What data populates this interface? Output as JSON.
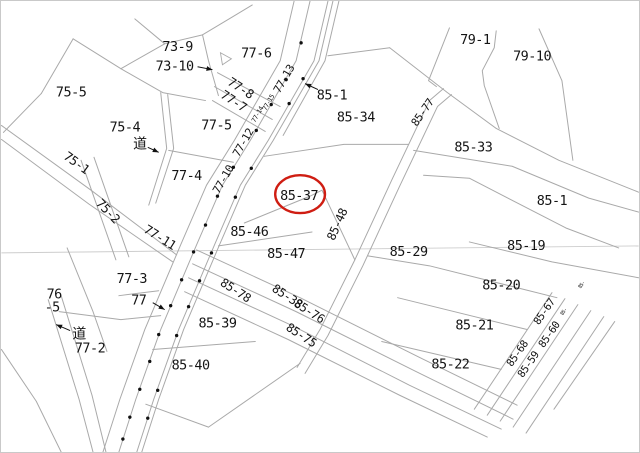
{
  "map": {
    "title": "cadastral-parcel-map",
    "highlight": {
      "parcel": "85-37",
      "color": "#cf1d12"
    },
    "colors": {
      "line": "#a9a9a9",
      "faint": "#cdcdcd",
      "text": "#141414",
      "dot": "#111111"
    },
    "labels": [
      {
        "t": "73-9",
        "x": 177,
        "y": 50,
        "r": 0,
        "s": 13.5
      },
      {
        "t": "73-10",
        "x": 174,
        "y": 70,
        "r": 0,
        "s": 13.5
      },
      {
        "t": "77-6",
        "x": 256,
        "y": 57,
        "r": 0,
        "s": 13.5
      },
      {
        "t": "75-5",
        "x": 70,
        "y": 96,
        "r": 0,
        "s": 13.5
      },
      {
        "t": "77-8",
        "x": 238,
        "y": 91,
        "r": 33,
        "s": 12.5
      },
      {
        "t": "77-7",
        "x": 231,
        "y": 104,
        "r": 33,
        "s": 12.5
      },
      {
        "t": "77-5",
        "x": 216,
        "y": 129,
        "r": 0,
        "s": 13.5
      },
      {
        "t": "75-4",
        "x": 124,
        "y": 131,
        "r": 0,
        "s": 13.5
      },
      {
        "t": "道",
        "x": 139,
        "y": 148,
        "r": 0,
        "s": 14
      },
      {
        "t": "77-13",
        "x": 287,
        "y": 80,
        "r": -60,
        "s": 11
      },
      {
        "t": "77-15",
        "x": 270,
        "y": 103,
        "r": -60,
        "s": 6.5
      },
      {
        "t": "77-14",
        "x": 259,
        "y": 115,
        "r": -60,
        "s": 6.5
      },
      {
        "t": "77-12",
        "x": 246,
        "y": 144,
        "r": -60,
        "s": 11
      },
      {
        "t": "77-10",
        "x": 226,
        "y": 181,
        "r": -60,
        "s": 11
      },
      {
        "t": "85-1",
        "x": 332,
        "y": 99,
        "r": 0,
        "s": 13.5
      },
      {
        "t": "85-34",
        "x": 356,
        "y": 121,
        "r": 0,
        "s": 13.5
      },
      {
        "t": "85-77",
        "x": 426,
        "y": 114,
        "r": -55,
        "s": 11
      },
      {
        "t": "79-1",
        "x": 476,
        "y": 43,
        "r": 0,
        "s": 13.5
      },
      {
        "t": "79-10",
        "x": 533,
        "y": 60,
        "r": 0,
        "s": 13.5
      },
      {
        "t": "85-33",
        "x": 474,
        "y": 151,
        "r": 0,
        "s": 13.5
      },
      {
        "t": "85-1",
        "x": 553,
        "y": 205,
        "r": 0,
        "s": 13.5
      },
      {
        "t": "75-1",
        "x": 73,
        "y": 166,
        "r": 36,
        "s": 12.5
      },
      {
        "t": "77-4",
        "x": 186,
        "y": 180,
        "r": 0,
        "s": 13.5
      },
      {
        "t": "75-2",
        "x": 104,
        "y": 214,
        "r": 46,
        "s": 12.5
      },
      {
        "t": "85-37",
        "x": 299,
        "y": 200,
        "r": 0,
        "s": 13.5
      },
      {
        "t": "85-48",
        "x": 341,
        "y": 226,
        "r": -66,
        "s": 12
      },
      {
        "t": "77-11",
        "x": 157,
        "y": 241,
        "r": 32,
        "s": 12.5
      },
      {
        "t": "85-46",
        "x": 249,
        "y": 236,
        "r": 0,
        "s": 13.5
      },
      {
        "t": "85-47",
        "x": 286,
        "y": 258,
        "r": 0,
        "s": 13.5
      },
      {
        "t": "85-29",
        "x": 409,
        "y": 256,
        "r": 0,
        "s": 13.5
      },
      {
        "t": "85-19",
        "x": 527,
        "y": 250,
        "r": 0,
        "s": 13.5
      },
      {
        "t": "77-3",
        "x": 131,
        "y": 283,
        "r": 0,
        "s": 13.5
      },
      {
        "t": "77",
        "x": 138,
        "y": 305,
        "r": 0,
        "s": 13.5
      },
      {
        "t": "76",
        "x": 53,
        "y": 299,
        "r": 0,
        "s": 13.5
      },
      {
        "t": "-5",
        "x": 51,
        "y": 312,
        "r": 0,
        "s": 13.5
      },
      {
        "t": "85-78",
        "x": 233,
        "y": 294,
        "r": 33,
        "s": 12
      },
      {
        "t": "85-38",
        "x": 285,
        "y": 300,
        "r": 33,
        "s": 12
      },
      {
        "t": "85-76",
        "x": 307,
        "y": 315,
        "r": 33,
        "s": 12
      },
      {
        "t": "85-75",
        "x": 299,
        "y": 339,
        "r": 33,
        "s": 12
      },
      {
        "t": "道",
        "x": 78,
        "y": 339,
        "r": 0,
        "s": 14
      },
      {
        "t": "77-2",
        "x": 89,
        "y": 353,
        "r": 0,
        "s": 13.5
      },
      {
        "t": "85-39",
        "x": 217,
        "y": 328,
        "r": 0,
        "s": 13.5
      },
      {
        "t": "85-40",
        "x": 190,
        "y": 370,
        "r": 0,
        "s": 13.5
      },
      {
        "t": "85-20",
        "x": 502,
        "y": 290,
        "r": 0,
        "s": 13.5
      },
      {
        "t": "85-21",
        "x": 475,
        "y": 330,
        "r": 0,
        "s": 13.5
      },
      {
        "t": "85-22",
        "x": 451,
        "y": 369,
        "r": 0,
        "s": 13.5
      },
      {
        "t": "85-67",
        "x": 548,
        "y": 314,
        "r": -55,
        "s": 10.5
      },
      {
        "t": "85-60",
        "x": 553,
        "y": 337,
        "r": -55,
        "s": 10.5
      },
      {
        "t": "85-68",
        "x": 521,
        "y": 356,
        "r": -55,
        "s": 10.5
      },
      {
        "t": "85-59",
        "x": 532,
        "y": 367,
        "r": -55,
        "s": 10.5
      },
      {
        "t": "85-",
        "x": 566,
        "y": 313,
        "r": -55,
        "s": 5
      },
      {
        "t": "85-",
        "x": 584,
        "y": 286,
        "r": -55,
        "s": 5
      }
    ],
    "polylines": [
      {
        "p": "294,0 280,60 234,140 206,185 180,245 144,330 119,400 102,453"
      },
      {
        "p": "310,0 296,60 250,140 222,185 196,245 160,330 135,400 118,453"
      },
      {
        "p": "328,0 314,60 268,140 240,185 214,245 178,330 153,400 136,453"
      },
      {
        "p": "333,0 319,60 273,140 245,185 219,245 183,330 158,400 141,453"
      },
      {
        "p": "339,0 325,60 283,135"
      },
      {
        "p": "134,18 164,43"
      },
      {
        "p": "164,43 202,34"
      },
      {
        "p": "202,34 232,16 252,4"
      },
      {
        "p": "202,34 208,60 218,95"
      },
      {
        "p": "164,43 120,68"
      },
      {
        "p": "72,38 120,68 162,92 205,100"
      },
      {
        "p": "72,38 40,93"
      },
      {
        "p": "40,93 2,132"
      },
      {
        "p": "160,92 166,148 148,205"
      },
      {
        "p": "167,94 173,148 155,203"
      },
      {
        "p": "217,72 280,106"
      },
      {
        "p": "214,86 272,119"
      },
      {
        "p": "212,100 265,131"
      },
      {
        "p": "168,150 233,162"
      },
      {
        "p": "0,125 90,190 176,255"
      },
      {
        "p": "0,139 88,204 172,262"
      },
      {
        "p": "80,160 115,260"
      },
      {
        "p": "93,157 128,257"
      },
      {
        "p": "66,248 92,312 106,352"
      },
      {
        "p": "47,300 78,400 92,453"
      },
      {
        "p": "60,296 91,396 105,453"
      },
      {
        "p": "0,350 35,402 60,453"
      },
      {
        "p": "58,312 120,320 160,316"
      },
      {
        "p": "118,296 158,291"
      },
      {
        "p": "390,47 448,92 497,128 560,160 640,192"
      },
      {
        "p": "414,150 513,166 590,198 640,212"
      },
      {
        "p": "424,175 470,178 567,228 620,248"
      },
      {
        "p": "450,27 429,80 437,86"
      },
      {
        "p": "497,30 495,47 483,70 485,85 500,128"
      },
      {
        "p": "540,28 563,80 574,160"
      },
      {
        "p": "328,55 390,47"
      },
      {
        "p": "444,88 430,100 392,180 355,260 320,330 297,368"
      },
      {
        "p": "452,94 438,106 400,186 363,266 328,336 305,374"
      },
      {
        "p": "322,190 355,260"
      },
      {
        "p": "264,156 344,144 409,144"
      },
      {
        "p": "244,223 310,196 322,190"
      },
      {
        "p": "218,246 312,232"
      },
      {
        "p": "196,250 300,298 420,358 518,406"
      },
      {
        "p": "192,264 296,312 416,372 514,420"
      },
      {
        "p": "188,278 292,326 410,386 502,430"
      },
      {
        "p": "184,292 288,340 400,396 488,438"
      },
      {
        "p": "470,242 553,262 640,278"
      },
      {
        "p": "368,256 430,266 558,298"
      },
      {
        "p": "398,298 528,330"
      },
      {
        "p": "382,342 502,370"
      },
      {
        "p": "553,293 475,410"
      },
      {
        "p": "566,299 488,416"
      },
      {
        "p": "579,305 501,422"
      },
      {
        "p": "592,311 514,428"
      },
      {
        "p": "605,317 527,434"
      },
      {
        "p": "616,322 555,410"
      },
      {
        "p": "145,405 208,428"
      },
      {
        "p": "208,428 300,364"
      },
      {
        "p": "152,350 255,342"
      }
    ],
    "faint_lines": [
      {
        "p": "0,253 640,246"
      }
    ],
    "triangle": "220,52 231,58 222,64",
    "ellipse": {
      "cx": 300,
      "cy": 194,
      "rx": 25,
      "ry": 19,
      "w": 2.4
    },
    "arrows": [
      {
        "x1": 197,
        "y1": 66,
        "x2": 212,
        "y2": 69
      },
      {
        "x1": 318,
        "y1": 89,
        "x2": 305,
        "y2": 83
      },
      {
        "x1": 147,
        "y1": 147,
        "x2": 158,
        "y2": 152
      },
      {
        "x1": 152,
        "y1": 303,
        "x2": 164,
        "y2": 310
      },
      {
        "x1": 69,
        "y1": 331,
        "x2": 55,
        "y2": 325
      }
    ],
    "dots": [
      [
        301,
        42
      ],
      [
        303,
        78
      ],
      [
        286,
        79
      ],
      [
        271,
        104
      ],
      [
        289,
        103
      ],
      [
        256,
        130
      ],
      [
        233,
        167
      ],
      [
        251,
        168
      ],
      [
        217,
        196
      ],
      [
        235,
        197
      ],
      [
        205,
        225
      ],
      [
        193,
        252
      ],
      [
        211,
        253
      ],
      [
        181,
        280
      ],
      [
        199,
        281
      ],
      [
        170,
        306
      ],
      [
        188,
        307
      ],
      [
        158,
        335
      ],
      [
        176,
        336
      ],
      [
        149,
        362
      ],
      [
        139,
        390
      ],
      [
        157,
        391
      ],
      [
        129,
        418
      ],
      [
        147,
        419
      ],
      [
        122,
        440
      ]
    ]
  }
}
